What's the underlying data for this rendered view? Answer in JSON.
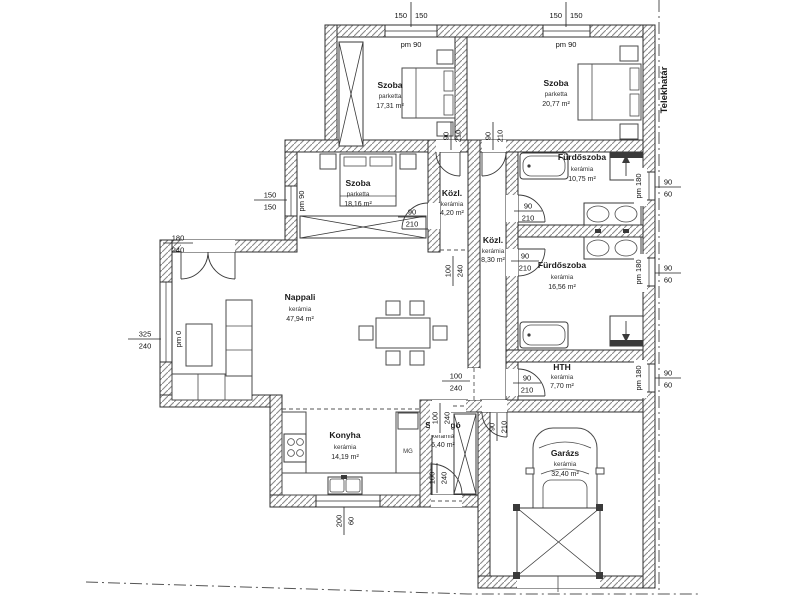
{
  "plan": {
    "boundary_label": "Telekhatár",
    "rooms": {
      "szoba1": {
        "name": "Szoba",
        "floor": "parketta",
        "area": "17,31 m²"
      },
      "szoba2": {
        "name": "Szoba",
        "floor": "parketta",
        "area": "20,77 m²"
      },
      "szoba3": {
        "name": "Szoba",
        "floor": "parketta",
        "area": "18,16 m²"
      },
      "kozl1": {
        "name": "Közl.",
        "floor": "kerámia",
        "area": "4,20 m²"
      },
      "kozl2": {
        "name": "Közl.",
        "floor": "kerámia",
        "area": "8,30 m²"
      },
      "furdoszoba1": {
        "name": "Fürdőszoba",
        "floor": "kerámia",
        "area": "10,75 m²"
      },
      "furdoszoba2": {
        "name": "Fürdőszoba",
        "floor": "kerámia",
        "area": "16,56 m²"
      },
      "hth": {
        "name": "HTH",
        "floor": "kerámia",
        "area": "7,70 m²"
      },
      "nappali": {
        "name": "Nappali",
        "floor": "kerámia",
        "area": "47,94 m²"
      },
      "konyha": {
        "name": "Konyha",
        "floor": "kerámia",
        "area": "14,19 m²"
      },
      "szelfogo": {
        "name": "Szélfogó",
        "floor": "kerámia",
        "area": "6,40 m²"
      },
      "garazs": {
        "name": "Garázs",
        "floor": "kerámia",
        "area": "32,40 m²"
      }
    },
    "dims": {
      "win_top1": {
        "a": "150",
        "b": "150",
        "pm": "pm 90"
      },
      "win_top2": {
        "a": "150",
        "b": "150",
        "pm": "pm 90"
      },
      "win_szoba3": {
        "a": "150",
        "b": "150",
        "pm": "pm 90"
      },
      "door_terasz": {
        "a": "180",
        "b": "240"
      },
      "win_nappali": {
        "a": "325",
        "b": "240",
        "pm": "pm 0"
      },
      "win_konyha": {
        "a": "200",
        "b": "60"
      },
      "win_furdoszoba1": {
        "a": "90",
        "b": "60",
        "pm": "pm 180"
      },
      "win_furdoszoba2": {
        "a": "90",
        "b": "60",
        "pm": "pm 180"
      },
      "win_hth": {
        "a": "90",
        "b": "60",
        "pm": "pm 180"
      },
      "door_szoba1": {
        "a": "90",
        "b": "210"
      },
      "door_szoba2": {
        "a": "90",
        "b": "210"
      },
      "door_szoba3": {
        "a": "90",
        "b": "210"
      },
      "door_furdoszoba1": {
        "a": "90",
        "b": "210"
      },
      "door_furdoszoba2": {
        "a": "90",
        "b": "210"
      },
      "door_hth": {
        "a": "90",
        "b": "210"
      },
      "door_garazs": {
        "a": "90",
        "b": "210"
      },
      "door_bejarat": {
        "a": "100",
        "b": "240"
      },
      "open_kozl": {
        "a": "100",
        "b": "240"
      },
      "open_nappali": {
        "a": "100",
        "b": "240"
      },
      "open_szelfogo": {
        "a": "100",
        "b": "240"
      }
    },
    "labels": {
      "mg": "MG"
    }
  }
}
